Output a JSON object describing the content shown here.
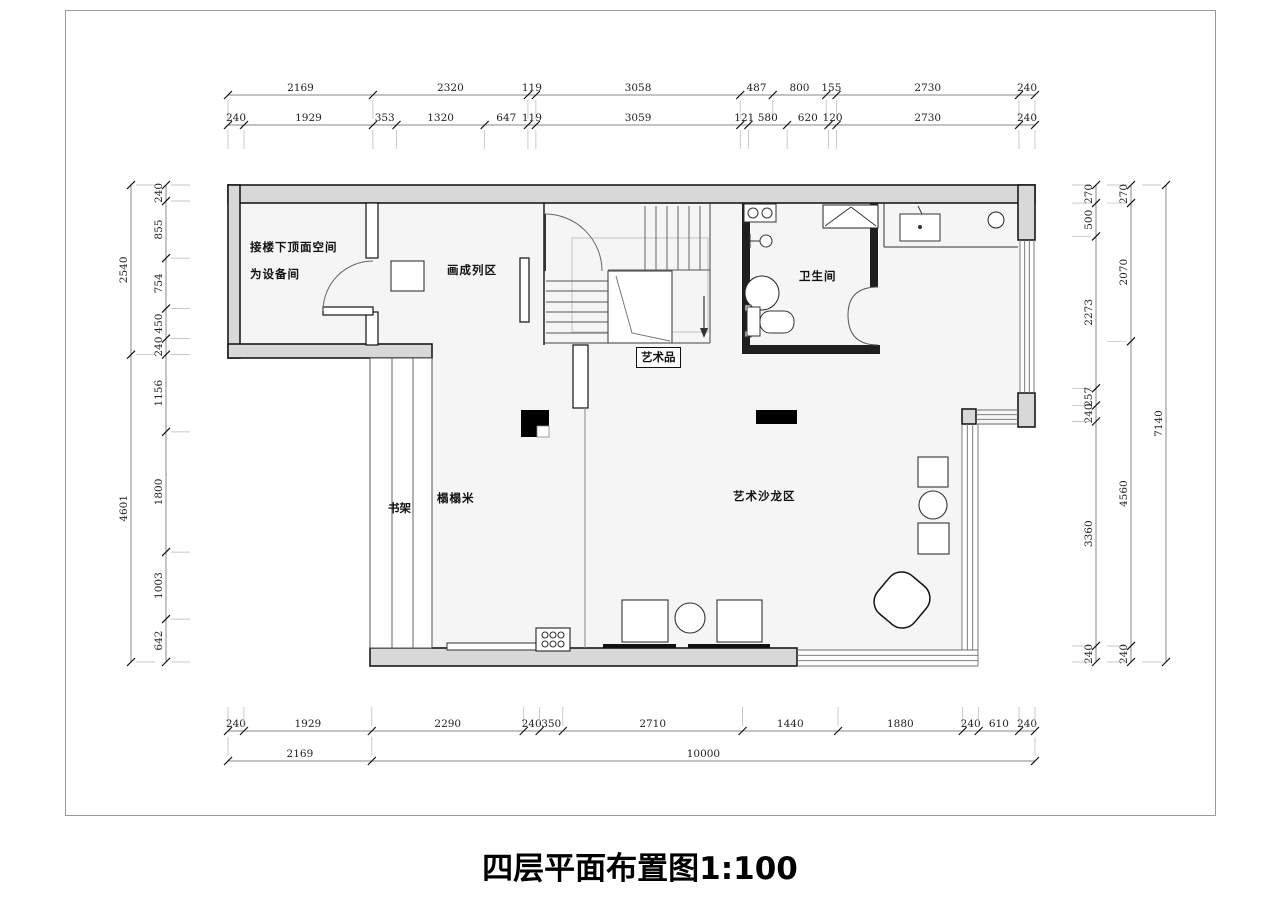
{
  "page": {
    "title": "四层平面布置图1:100"
  },
  "rooms": {
    "equipment_line1": "接楼下顶面空间",
    "equipment_line2": "为设备间",
    "gallery": "画成列区",
    "art_piece": "艺术品",
    "bathroom": "卫生间",
    "tatami": "榻榻米",
    "bookshelf": "书架",
    "salon": "艺术沙龙区"
  },
  "dims": {
    "top_row1": [
      2169,
      2320,
      119,
      3058,
      487,
      800,
      155,
      2730,
      240
    ],
    "top_row2": [
      240,
      1929,
      353,
      1320,
      647,
      119,
      3059,
      121,
      580,
      620,
      120,
      2730,
      240
    ],
    "bottom_row1": [
      240,
      1929,
      2290,
      240,
      350,
      2710,
      1440,
      1880,
      240,
      610,
      240
    ],
    "bottom_row2": [
      2169,
      10000
    ],
    "left_outer": [
      2540,
      4601
    ],
    "left_inner": [
      240,
      855,
      754,
      450,
      240,
      1156,
      1800,
      1003,
      642
    ],
    "right_inner": [
      270,
      500,
      2273,
      257,
      240,
      3360,
      240
    ],
    "right_middle": [
      270,
      2070,
      4560,
      240
    ],
    "right_outer": [
      7140
    ]
  },
  "colors": {
    "wall_fill": "#d8d8d8",
    "wall_line": "#1a1a1a",
    "floor": "#f5f5f5",
    "dim_text": "#222",
    "dim_line": "#8a8a8a"
  }
}
